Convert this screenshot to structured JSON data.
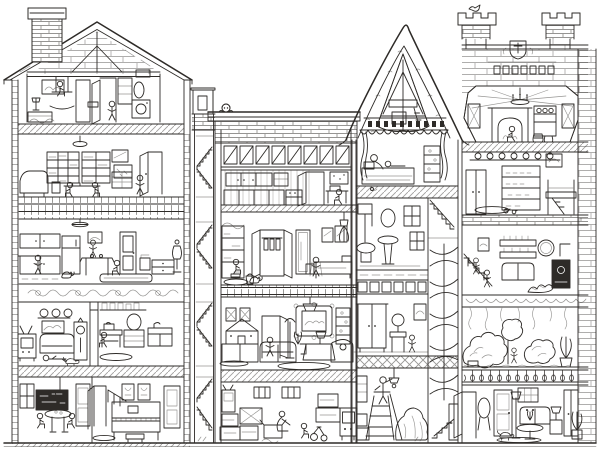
{
  "palette": {
    "ink": "#2e2b28",
    "paper": "#ffffff"
  },
  "figure_alt": "Hand-drawn black-and-white cutaway illustration of a multi-story dollhouse showing about eighteen furnished rooms across five floors, with chimneys, staircases and many tiny figures",
  "sections": {
    "left_house": {
      "label": "Gabled house with brick chimney",
      "rooms": [
        "attic playroom",
        "library study",
        "kitchen and dining room",
        "living room and sewing room",
        "classroom and music room"
      ]
    },
    "stair_tower": {
      "label": "Stairwell tower connecting all floors"
    },
    "middle_house": {
      "label": "Flat-roofed middle house with clerestory windows",
      "rooms": [
        "kitchen office",
        "bedroom with wardrobe and mirror",
        "parlor with dollhouse",
        "basement storage with boxes"
      ]
    },
    "tower": {
      "label": "Steep-roofed tower",
      "rooms": [
        "open rafter attic",
        "canopy bedroom",
        "bathroom",
        "dressing room",
        "workshop with stepladder",
        "spiral staircase"
      ]
    },
    "castle": {
      "label": "Stone castle wing with battlement chimneys",
      "rooms": [
        "great hall with chandelier and hearth",
        "pantry with plate rail and loft bed",
        "parlor with stove and stairs",
        "indoor garden conservatory",
        "sitting room"
      ]
    }
  }
}
